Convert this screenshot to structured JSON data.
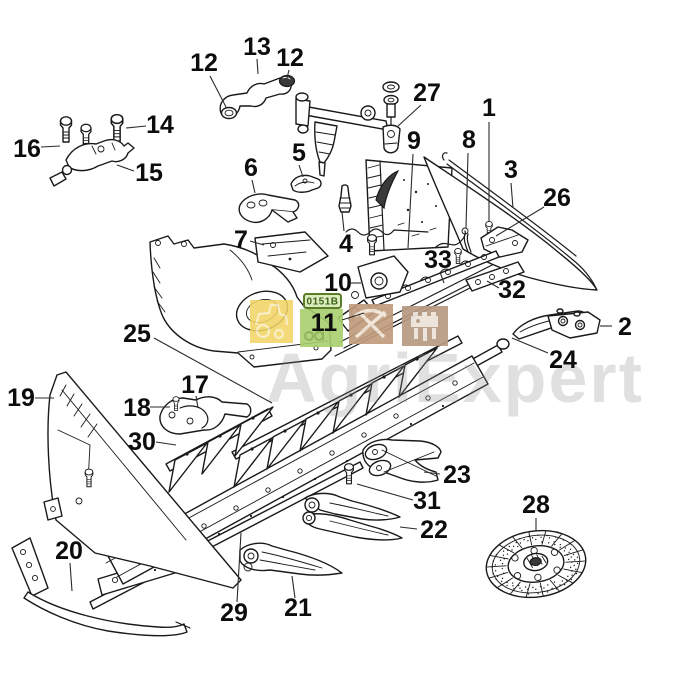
{
  "diagram": {
    "background": "#ffffff",
    "line_color": "#1a1a1a",
    "callout_color": "#0d0d0d"
  },
  "watermark": {
    "brand_text": "AgriExpert",
    "ref_code": "0151B",
    "colors": {
      "square_yellow": "#f2d465",
      "square_green": "#a9cf6e",
      "square_tan1": "#c09c7c",
      "square_tan2": "#b79a82",
      "ref_bg": "#dcebbe",
      "ref_border": "#5a7d2a",
      "ref_text": "#3f6418",
      "brand_gray": "#8f8f8f"
    }
  },
  "callouts": [
    {
      "label": "1",
      "tx": 489,
      "ty": 116,
      "leader": [
        489,
        122,
        489,
        222
      ]
    },
    {
      "label": "2",
      "tx": 625,
      "ty": 335,
      "leader": [
        612,
        326,
        600,
        326
      ]
    },
    {
      "label": "3",
      "tx": 511,
      "ty": 178,
      "leader": [
        511,
        183,
        513,
        208
      ]
    },
    {
      "label": "4",
      "tx": 346,
      "ty": 252,
      "leader": [
        344,
        231,
        342,
        212
      ]
    },
    {
      "label": "5",
      "tx": 299,
      "ty": 161,
      "leader": [
        299,
        165,
        303,
        177
      ]
    },
    {
      "label": "6",
      "tx": 251,
      "ty": 176,
      "leader": [
        252,
        180,
        255,
        193
      ]
    },
    {
      "label": "7",
      "tx": 241,
      "ty": 248,
      "leader": [
        250,
        241,
        264,
        245
      ]
    },
    {
      "label": "8",
      "tx": 469,
      "ty": 148,
      "leader": [
        468,
        153,
        466,
        228
      ]
    },
    {
      "label": "9",
      "tx": 414,
      "ty": 149,
      "leader": [
        413,
        154,
        408,
        248
      ]
    },
    {
      "label": "10",
      "tx": 338,
      "ty": 291,
      "leader": [
        351,
        283,
        361,
        283
      ]
    },
    {
      "label": "11",
      "tx": 324,
      "ty": 331,
      "leader": [
        342,
        320,
        364,
        313
      ]
    },
    {
      "label": "12",
      "tx": 204,
      "ty": 71,
      "leader": [
        210,
        76,
        226,
        107
      ]
    },
    {
      "label": "13",
      "tx": 257,
      "ty": 55,
      "leader": [
        257,
        59,
        258,
        74
      ]
    },
    {
      "label": "12",
      "tx": 290,
      "ty": 66,
      "leader": [
        289,
        70,
        287,
        78
      ]
    },
    {
      "label": "14",
      "tx": 160,
      "ty": 133,
      "leader": [
        146,
        126,
        126,
        128
      ]
    },
    {
      "label": "15",
      "tx": 149,
      "ty": 181,
      "leader": [
        134,
        171,
        117,
        165
      ]
    },
    {
      "label": "16",
      "tx": 27,
      "ty": 157,
      "leader": [
        41,
        147,
        60,
        146
      ]
    },
    {
      "label": "17",
      "tx": 195,
      "ty": 393,
      "leader": [
        196,
        396,
        198,
        408
      ]
    },
    {
      "label": "18",
      "tx": 137,
      "ty": 416,
      "leader": [
        150,
        407,
        170,
        407
      ]
    },
    {
      "label": "19",
      "tx": 21,
      "ty": 406,
      "leader": [
        35,
        398,
        54,
        398
      ]
    },
    {
      "label": "20",
      "tx": 69,
      "ty": 559,
      "leader": [
        70,
        563,
        72,
        591
      ]
    },
    {
      "label": "21",
      "tx": 298,
      "ty": 616,
      "leader": [
        295,
        598,
        292,
        576
      ]
    },
    {
      "label": "22",
      "tx": 434,
      "ty": 538,
      "leader": [
        417,
        529,
        400,
        527
      ]
    },
    {
      "label": "23",
      "tx": 457,
      "ty": 483,
      "leader": [
        440,
        474,
        424,
        472
      ]
    },
    {
      "label": "24",
      "tx": 563,
      "ty": 368,
      "leader": [
        548,
        353,
        512,
        338
      ]
    },
    {
      "label": "25",
      "tx": 137,
      "ty": 342,
      "leader": [
        154,
        338,
        272,
        403
      ]
    },
    {
      "label": "26",
      "tx": 557,
      "ty": 206,
      "leader": [
        544,
        207,
        496,
        236
      ]
    },
    {
      "label": "27",
      "tx": 427,
      "ty": 101,
      "leader": [
        421,
        105,
        398,
        126
      ]
    },
    {
      "label": "28",
      "tx": 536,
      "ty": 513,
      "leader": [
        536,
        518,
        536,
        531
      ]
    },
    {
      "label": "29",
      "tx": 234,
      "ty": 621,
      "leader": [
        237,
        602,
        241,
        533
      ]
    },
    {
      "label": "30",
      "tx": 142,
      "ty": 450,
      "leader": [
        156,
        442,
        176,
        445
      ]
    },
    {
      "label": "31",
      "tx": 427,
      "ty": 509,
      "leader": [
        413,
        500,
        357,
        484
      ]
    },
    {
      "label": "32",
      "tx": 512,
      "ty": 298,
      "leader": [
        499,
        288,
        487,
        281
      ]
    },
    {
      "label": "33",
      "tx": 438,
      "ty": 268,
      "leader": [
        440,
        272,
        444,
        283
      ]
    }
  ]
}
